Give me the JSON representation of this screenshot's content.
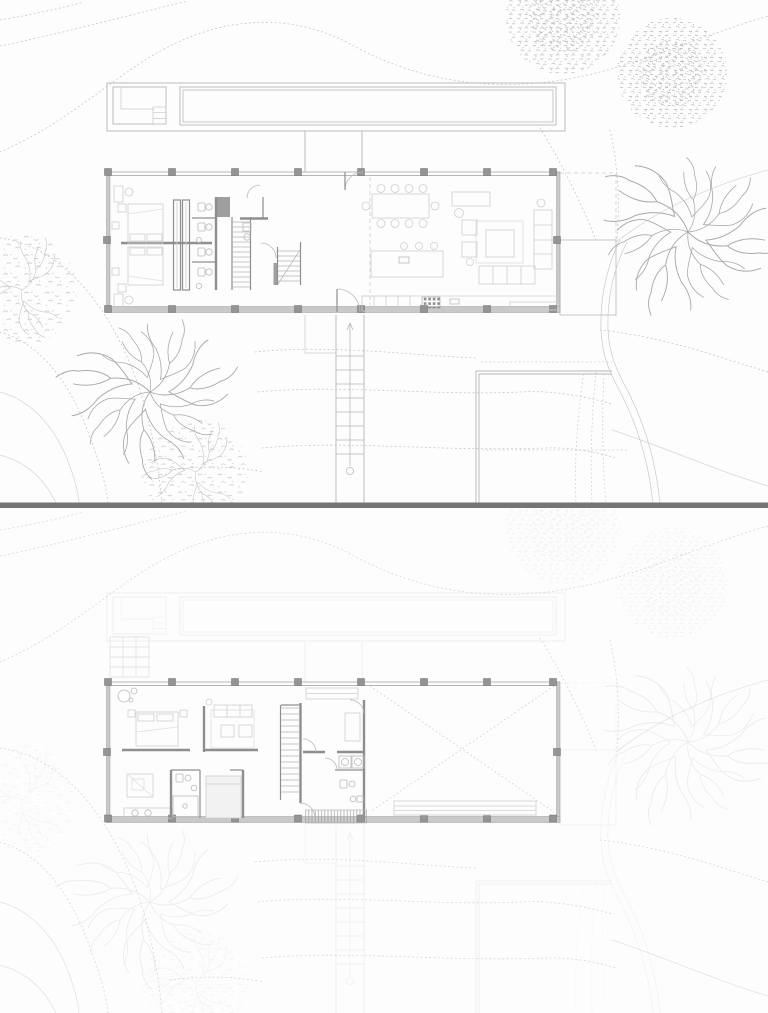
{
  "document": {
    "title": "Architectural drawing — hillside residence, upper and lower level floor plans on site",
    "type": "floor-plan-sheet",
    "text_labels": []
  },
  "sheets": {
    "upper": {
      "name": "Upper level plan with site",
      "site_features": [
        "topographic contour lines",
        "lap pool",
        "pool house with steps",
        "walkway connecting pool terrace to house",
        "dashed east deck",
        "exterior stair to lower terrace",
        "stone patio",
        "curving gravel drive",
        "two canopy trees",
        "two bare branch trees",
        "two sparse leafy trees"
      ],
      "rooms": [
        "bedroom 1",
        "bedroom 2",
        "wardrobe corridor",
        "bathrooms",
        "stair hall",
        "dining area",
        "kitchen",
        "living area"
      ],
      "furniture": [
        "double bed with nightstands (x2)",
        "built-in wardrobes",
        "toilets and basins",
        "main staircase",
        "secondary stair",
        "dining table with ten chairs",
        "credenza",
        "kitchen island with three stools",
        "cooktop and counter run",
        "sectional sofa",
        "coffee table on rug",
        "two armchairs",
        "floor lamp"
      ]
    },
    "lower": {
      "name": "Lower level plan (site shown ghosted)",
      "rooms": [
        "bedroom",
        "sitting room",
        "bathroom with shower",
        "inner bedroom",
        "stair hall",
        "wardrobe / utility room",
        "WC",
        "open multipurpose room marked with dashed X"
      ],
      "furniture": [
        "double bed",
        "armchair with ottoman",
        "twin-basin vanity",
        "shower",
        "sofa with two armchairs on rug",
        "wall closet",
        "dresser",
        "washer and dryer",
        "built-in bench",
        "deck grating hatch"
      ]
    }
  },
  "divider": {
    "name": "horizontal separator bar between the two plans"
  },
  "colors": {
    "bg": "#fdfdfd",
    "contour": "#c6c6c6",
    "contour_solid": "#d7d7d7",
    "site": "#b6b6b6",
    "site_light": "#c9c9c9",
    "tree": "#a9a9a9",
    "tree_sparse": "#b9b9b9",
    "wall": "#8e8e8e",
    "band_fill": "#c9c9c9",
    "band_edge": "#9e9e9e",
    "col_fill": "#949494",
    "col_edge": "#707070",
    "furn": "#cfcfcf",
    "furn_faint": "#dedede",
    "furn_fill": "#f2f2f2",
    "fix": "#bababa",
    "tread": "#b7b7b7",
    "dash": "#cccccc",
    "hatch": "#9c9c9c",
    "grid_light": "#dcdcdc",
    "divider": "#757575"
  },
  "render": {
    "ghost_opacity": "0.2",
    "contour_ghost_opacity": "0.7"
  }
}
